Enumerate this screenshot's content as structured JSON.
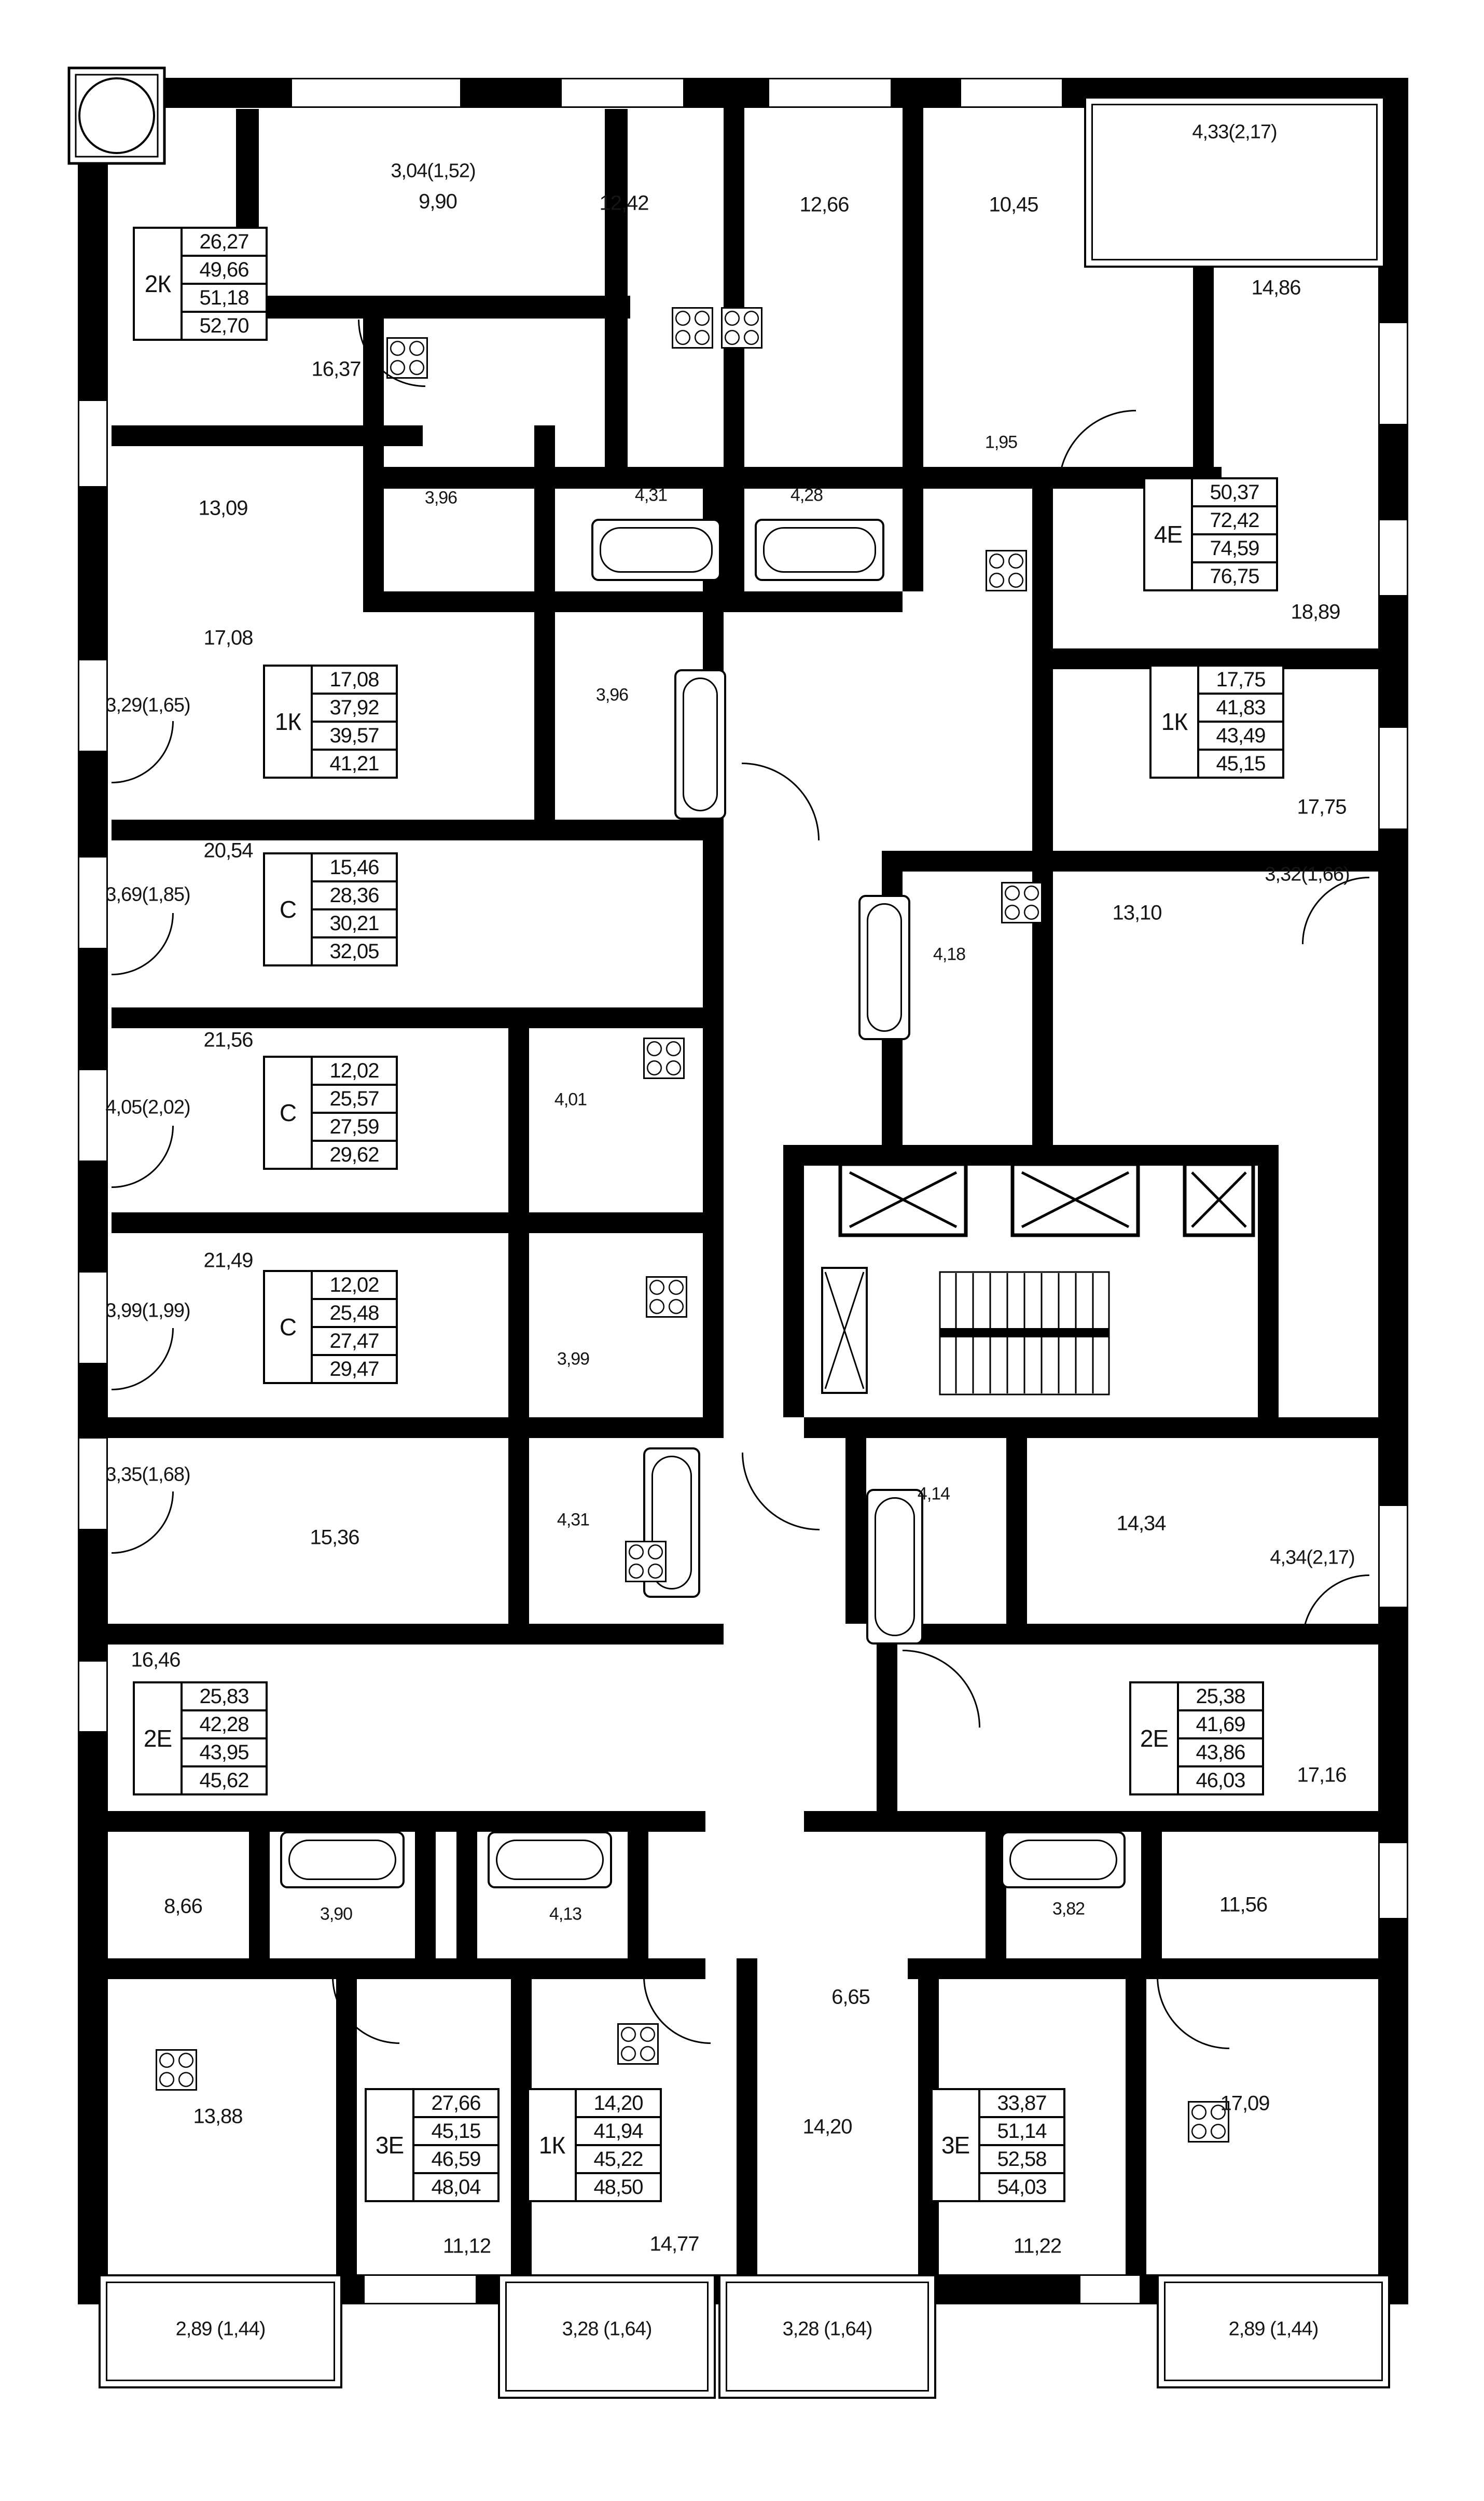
{
  "apartments": [
    {
      "type": "2К",
      "areas": [
        "26,27",
        "49,66",
        "51,18",
        "52,70"
      ]
    },
    {
      "type": "4Е",
      "areas": [
        "50,37",
        "72,42",
        "74,59",
        "76,75"
      ]
    },
    {
      "type": "1К",
      "areas": [
        "17,08",
        "37,92",
        "39,57",
        "41,21"
      ]
    },
    {
      "type": "1К",
      "areas": [
        "17,75",
        "41,83",
        "43,49",
        "45,15"
      ]
    },
    {
      "type": "С",
      "areas": [
        "15,46",
        "28,36",
        "30,21",
        "32,05"
      ]
    },
    {
      "type": "С",
      "areas": [
        "12,02",
        "25,57",
        "27,59",
        "29,62"
      ]
    },
    {
      "type": "С",
      "areas": [
        "12,02",
        "25,48",
        "27,47",
        "29,47"
      ]
    },
    {
      "type": "2Е",
      "areas": [
        "25,83",
        "42,28",
        "43,95",
        "45,62"
      ]
    },
    {
      "type": "2Е",
      "areas": [
        "25,38",
        "41,69",
        "43,86",
        "46,03"
      ]
    },
    {
      "type": "3Е",
      "areas": [
        "27,66",
        "45,15",
        "46,59",
        "48,04"
      ]
    },
    {
      "type": "1К",
      "areas": [
        "14,20",
        "41,94",
        "45,22",
        "48,50"
      ]
    },
    {
      "type": "3Е",
      "areas": [
        "33,87",
        "51,14",
        "52,58",
        "54,03"
      ]
    }
  ],
  "rooms": [
    {
      "label": "9,90"
    },
    {
      "label": "12,42"
    },
    {
      "label": "12,66"
    },
    {
      "label": "10,45"
    },
    {
      "label": "14,86"
    },
    {
      "label": "16,37"
    },
    {
      "label": "13,09"
    },
    {
      "label": "3,96"
    },
    {
      "label": "4,31"
    },
    {
      "label": "4,28"
    },
    {
      "label": "1,95"
    },
    {
      "label": "18,89"
    },
    {
      "label": "17,08"
    },
    {
      "label": "3,96"
    },
    {
      "label": "17,75"
    },
    {
      "label": "20,54"
    },
    {
      "label": "4,18"
    },
    {
      "label": "13,10"
    },
    {
      "label": "21,56"
    },
    {
      "label": "4,01"
    },
    {
      "label": "21,49"
    },
    {
      "label": "3,99"
    },
    {
      "label": "15,36"
    },
    {
      "label": "4,31"
    },
    {
      "label": "4,14"
    },
    {
      "label": "14,34"
    },
    {
      "label": "16,46"
    },
    {
      "label": "17,16"
    },
    {
      "label": "8,66"
    },
    {
      "label": "3,90"
    },
    {
      "label": "4,13"
    },
    {
      "label": "3,82"
    },
    {
      "label": "11,56"
    },
    {
      "label": "6,65"
    },
    {
      "label": "13,88"
    },
    {
      "label": "14,20"
    },
    {
      "label": "17,09"
    },
    {
      "label": "11,12"
    },
    {
      "label": "14,77"
    },
    {
      "label": "11,22"
    }
  ],
  "balconies": [
    {
      "label": "3,04(1,52)"
    },
    {
      "label": "4,33(2,17)"
    },
    {
      "label": "3,29(1,65)"
    },
    {
      "label": "3,69(1,85)"
    },
    {
      "label": "4,05(2,02)"
    },
    {
      "label": "3,99(1,99)"
    },
    {
      "label": "3,35(1,68)"
    },
    {
      "label": "3,32(1,66)"
    },
    {
      "label": "4,34(2,17)"
    },
    {
      "label": "2,89 (1,44)"
    },
    {
      "label": "3,28 (1,64)"
    },
    {
      "label": "3,28 (1,64)"
    },
    {
      "label": "2,89 (1,44)"
    }
  ],
  "colors": {
    "wall": "#000000",
    "background": "#ffffff",
    "text": "#151515"
  }
}
